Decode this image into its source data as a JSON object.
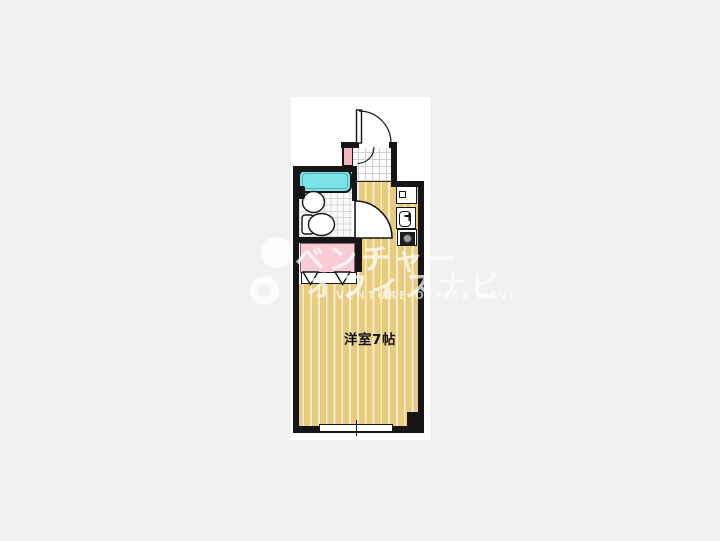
{
  "page": {
    "background": "#f1f1f0",
    "panel_background": "#ffffff"
  },
  "floorplan": {
    "room_label": "洋室7帖",
    "rooms": {
      "main_room": "洋室7帖",
      "areas": [
        "genkan-entrance",
        "unit-bath",
        "closet",
        "kitchenette",
        "main-room"
      ]
    },
    "fixtures": [
      "entrance-door",
      "bathtub",
      "wash-basin",
      "toilet",
      "bath-door",
      "shoe-cabinet",
      "closet-folding-door",
      "kitchen-cabinet",
      "kitchen-sink",
      "stove",
      "window",
      "pillar"
    ],
    "colors": {
      "wall": "#161616",
      "floor": "#e9cb7c",
      "floor_stripe": "#f7edd3",
      "tile_line": "#cfcfcf",
      "bathtub": "#7ce3e6",
      "closet_pink": "#f8ccd2",
      "shoebox_pink": "#f2b6c2",
      "stove_dark": "#1d1d1d",
      "burner_gray": "#9a9a9a"
    }
  },
  "watermark": {
    "line1": "ベンチャー",
    "line2": "オフィスナビ",
    "line3": "VENTURE OFFICE NAVI"
  }
}
